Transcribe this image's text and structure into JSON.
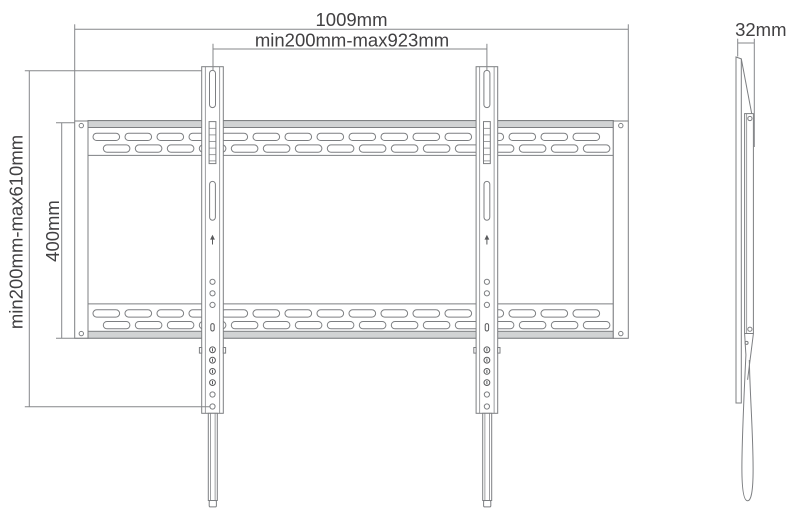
{
  "diagram": {
    "type": "technical-drawing",
    "subject": "flat TV wall mount bracket",
    "front_view": {
      "name": "front view",
      "dim_overall_width": "1009mm",
      "dim_horizontal_vesa": "min200mm-max923mm",
      "dim_vertical_vesa": "min200mm-max610mm",
      "dim_plate_height": "400mm"
    },
    "side_view": {
      "name": "side view",
      "dim_depth": "32mm"
    },
    "colors": {
      "line": "#7d7f82",
      "dim": "#85878a",
      "dark": "#58595b",
      "fill": "#d1d3d4",
      "text": "#414042",
      "bg": "#ffffff"
    }
  }
}
